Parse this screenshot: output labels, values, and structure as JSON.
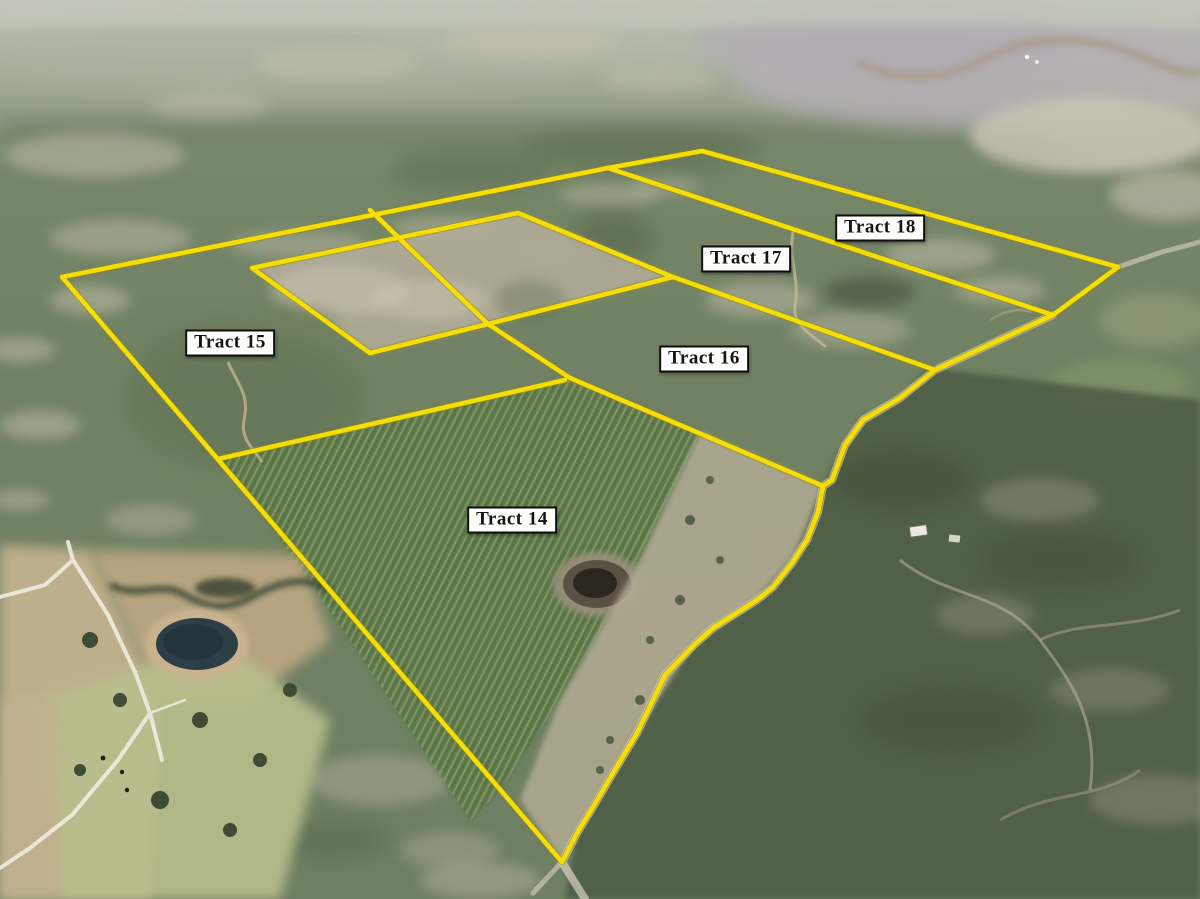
{
  "tracts": [
    {
      "id": "tract-14",
      "label": "Tract 14"
    },
    {
      "id": "tract-15",
      "label": "Tract 15"
    },
    {
      "id": "tract-16",
      "label": "Tract 16"
    },
    {
      "id": "tract-17",
      "label": "Tract 17"
    },
    {
      "id": "tract-18",
      "label": "Tract 18"
    }
  ],
  "colors": {
    "boundary_line": "#f5de07",
    "boundary_line_edge": "#9a8300",
    "label_background": "#fdfdfb",
    "label_border": "#0d0d0d",
    "label_text": "#151515"
  },
  "boundaries": {
    "outer": "62,277 608,168 702,151 1118,267 1053,315 935,370 900,398 863,420 845,445 832,480 823,486 818,512 807,540 792,563 773,587 757,600 713,628 694,645 665,675 637,733 613,773 593,807 577,833 562,862 62,277",
    "tract18_tract17_divider": "608,168 1053,315",
    "tract17_tract16_divider": "673,277 935,370",
    "tract16_tract14_divider": "488,324 570,378 680,425 823,486",
    "tract15_tract14_divider": "218,459 565,380",
    "clearcut_parcel": "252,268 518,213 673,277 488,324 370,353 252,268",
    "clearcut_cross": "370,210 488,324"
  }
}
